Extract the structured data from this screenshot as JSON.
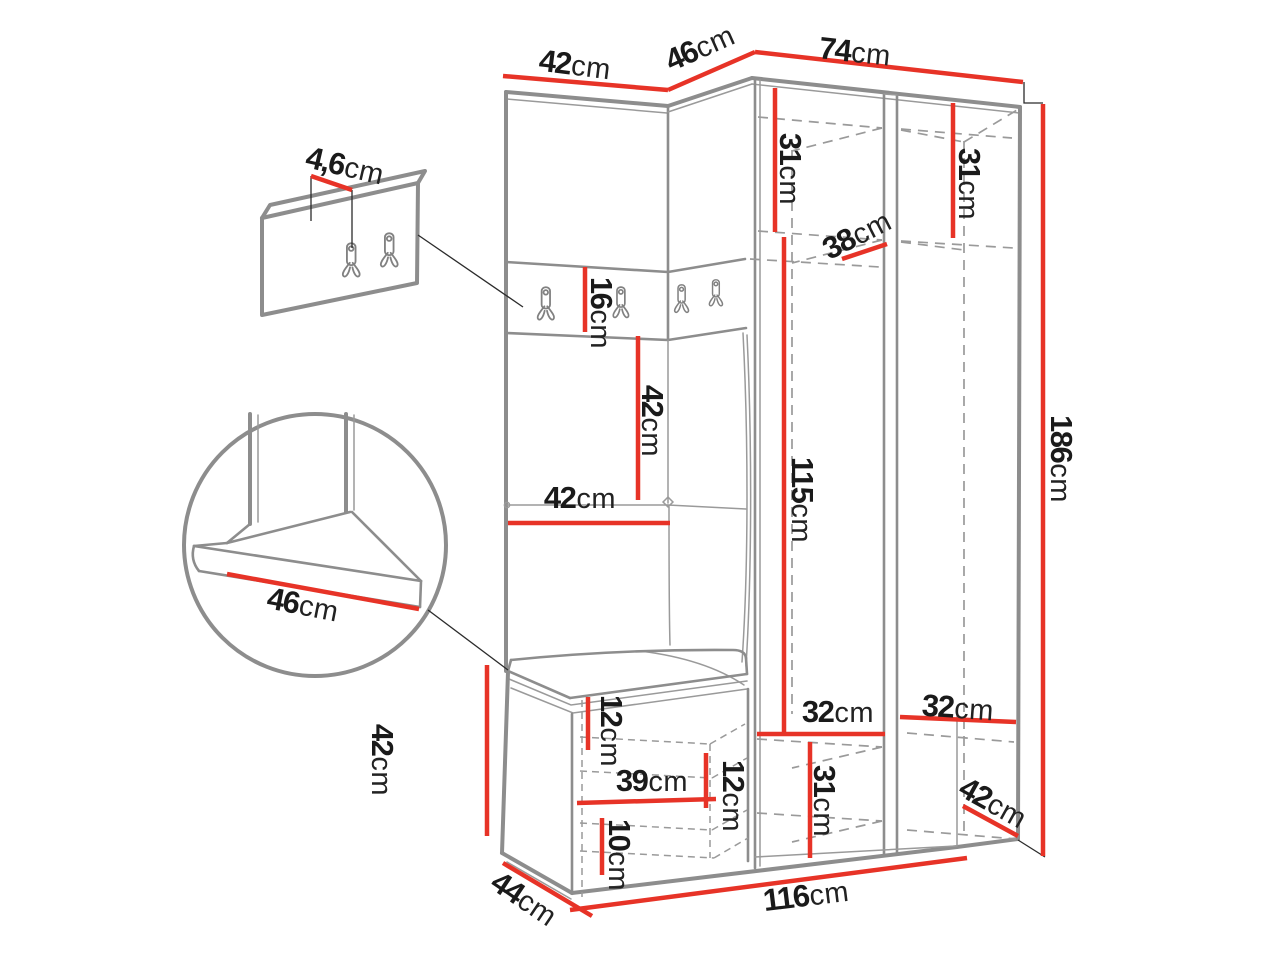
{
  "diagram": "furniture-dimension-drawing",
  "units": "cm",
  "colors": {
    "dimension_red": "#e73327",
    "outline_gray": "#8d8d8d",
    "text_black": "#1a1a1a"
  },
  "dimensions": [
    {
      "id": "top-panel-width",
      "value": "42",
      "unit": "cm"
    },
    {
      "id": "corner-width",
      "value": "46",
      "unit": "cm"
    },
    {
      "id": "wardrobe-width",
      "value": "74",
      "unit": "cm"
    },
    {
      "id": "hook-panel-thickness",
      "value": "4,6",
      "unit": "cm"
    },
    {
      "id": "hook-strip-height",
      "value": "16",
      "unit": "cm"
    },
    {
      "id": "padded-section-height",
      "value": "42",
      "unit": "cm"
    },
    {
      "id": "padded-section-width",
      "value": "42",
      "unit": "cm"
    },
    {
      "id": "interior-left-top-height",
      "value": "31",
      "unit": "cm"
    },
    {
      "id": "interior-right-top-height",
      "value": "31",
      "unit": "cm"
    },
    {
      "id": "shelf-depth",
      "value": "38",
      "unit": "cm"
    },
    {
      "id": "hanging-space-height",
      "value": "115",
      "unit": "cm"
    },
    {
      "id": "total-height",
      "value": "186",
      "unit": "cm"
    },
    {
      "id": "interior-bottom-left-width",
      "value": "32",
      "unit": "cm"
    },
    {
      "id": "interior-bottom-right-width",
      "value": "32",
      "unit": "cm"
    },
    {
      "id": "interior-bottom-height",
      "value": "31",
      "unit": "cm"
    },
    {
      "id": "wardrobe-depth",
      "value": "42",
      "unit": "cm"
    },
    {
      "id": "total-width",
      "value": "116",
      "unit": "cm"
    },
    {
      "id": "bench-depth",
      "value": "44",
      "unit": "cm"
    },
    {
      "id": "bench-height",
      "value": "42",
      "unit": "cm"
    },
    {
      "id": "seat-depth",
      "value": "46",
      "unit": "cm"
    },
    {
      "id": "bench-top-offset",
      "value": "12",
      "unit": "cm"
    },
    {
      "id": "bench-interior-width",
      "value": "39",
      "unit": "cm"
    },
    {
      "id": "bench-shelf-gap",
      "value": "12",
      "unit": "cm"
    },
    {
      "id": "bench-bottom-gap",
      "value": "10",
      "unit": "cm"
    }
  ]
}
